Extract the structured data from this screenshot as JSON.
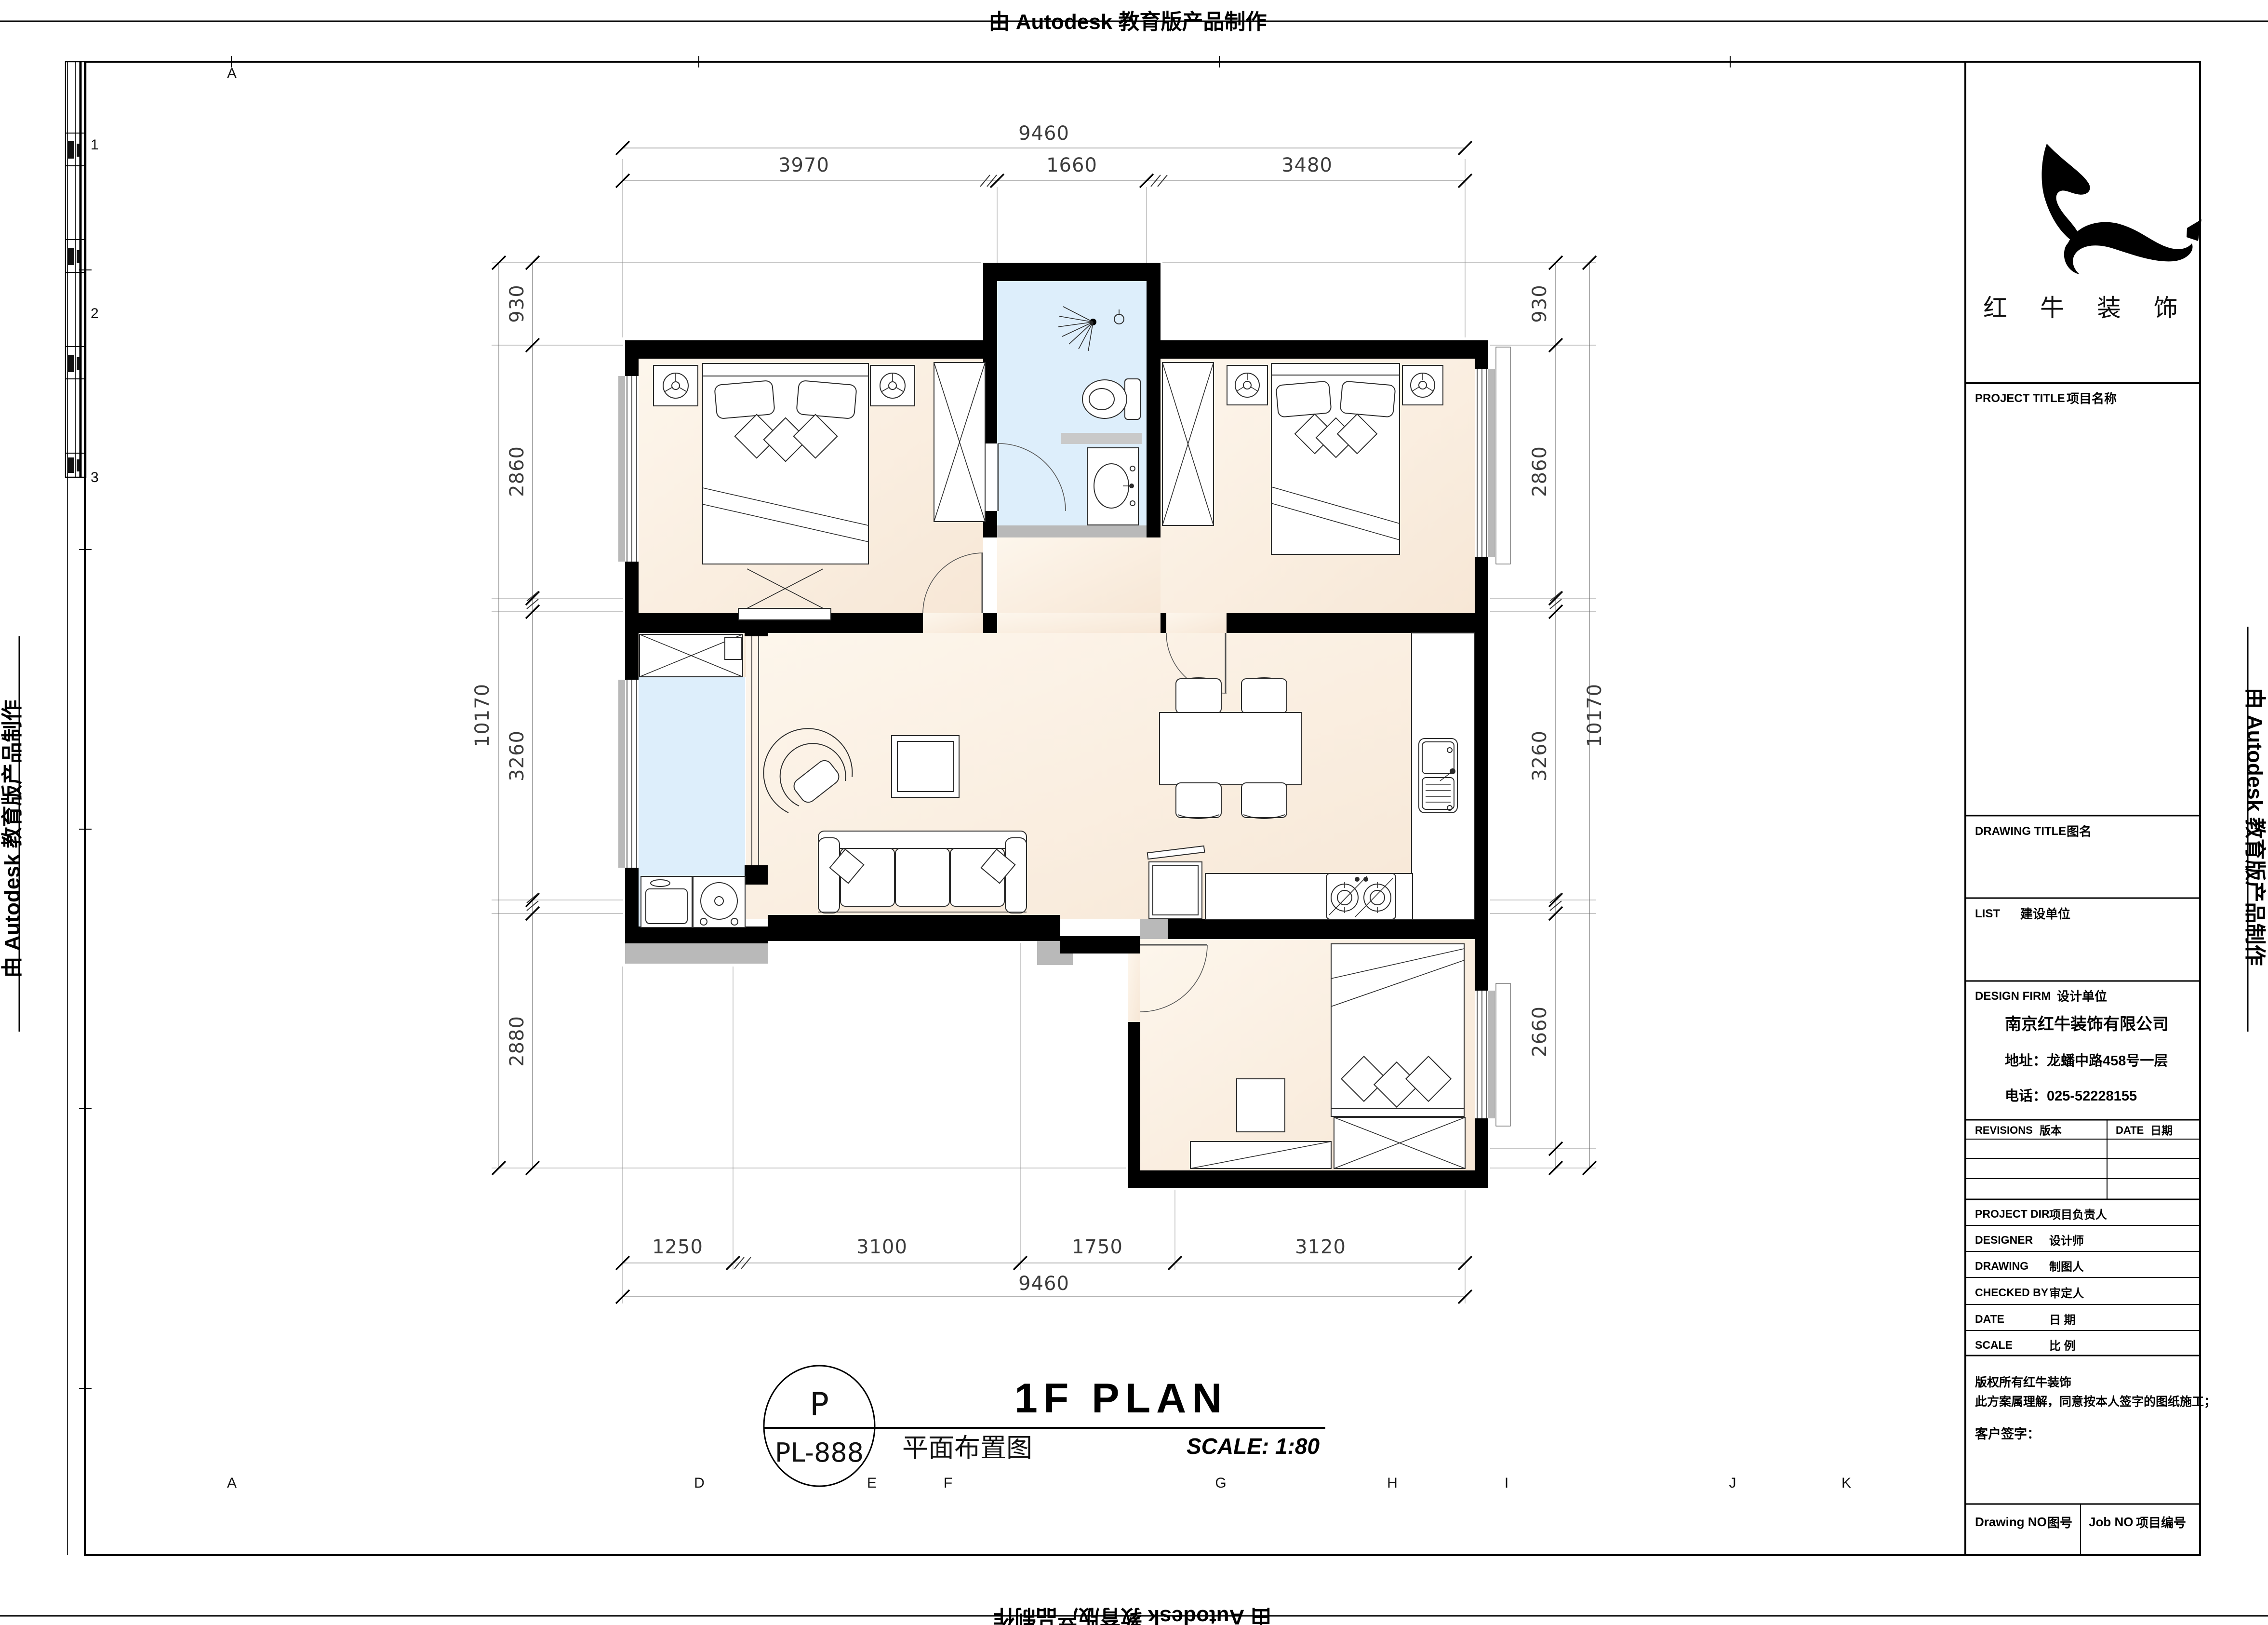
{
  "watermarks": {
    "top": "由 Autodesk 教育版产品制作",
    "bottom": "由 Autodesk 教育版产品制作",
    "left": "由 Autodesk 教育版产品制作",
    "right": "由 Autodesk 教育版产品制作"
  },
  "sheet": {
    "grid_top_letter": "A",
    "grid_bottom_letters": [
      "A",
      "D",
      "E",
      "F",
      "G",
      "H",
      "I",
      "J",
      "K"
    ],
    "grid_left_numbers": [
      "1",
      "2",
      "3"
    ]
  },
  "title_block": {
    "brand_name": "红 牛 装 饰",
    "sections": {
      "project_title_en": "PROJECT TITLE",
      "project_title_zh": "项目名称",
      "drawing_title_en": "DRAWING TITLE",
      "drawing_title_zh": "图名",
      "list_en": "LIST",
      "list_zh": "建设单位",
      "design_firm_en": "DESIGN FIRM",
      "design_firm_zh": "设计单位"
    },
    "company": {
      "name": "南京红牛装饰有限公司",
      "address": "地址：龙蟠中路458号一层",
      "phone": "电话：025-52228155"
    },
    "revisions_en": "REVISIONS",
    "revisions_zh": "版本",
    "date_col_en": "DATE",
    "date_col_zh": "日期",
    "rows": [
      {
        "en": "PROJECT DIR",
        "zh": "项目负责人"
      },
      {
        "en": "DESIGNER",
        "zh": "设计师"
      },
      {
        "en": "DRAWING",
        "zh": "制图人"
      },
      {
        "en": "CHECKED BY",
        "zh": "审定人"
      },
      {
        "en": "DATE",
        "zh": "日  期"
      },
      {
        "en": "SCALE",
        "zh": "比  例"
      }
    ],
    "note_line1": "版权所有红牛装饰",
    "note_line2": "此方案属理解，同意按本人签字的图纸施工；",
    "note_line3": "客户签字：",
    "footer_left_en": "Drawing NO",
    "footer_left_zh": "图号",
    "footer_right_en": "Job NO",
    "footer_right_zh": "项目编号"
  },
  "caption": {
    "bubble_top": "P",
    "bubble_bottom": "PL-888",
    "title": "1F PLAN",
    "subtitle": "平面布置图",
    "scale_label": "SCALE:  1:80"
  },
  "dimensions": {
    "top": {
      "overall": "9460",
      "seg1": "3970",
      "seg2": "1660",
      "seg3": "3480"
    },
    "bottom": {
      "overall": "9460",
      "seg1": "1250",
      "seg2": "3100",
      "seg3": "1750",
      "seg4": "3120"
    },
    "left": {
      "overall": "10170",
      "seg1": "930",
      "seg2": "2860",
      "seg3": "3260",
      "seg4": "2880"
    },
    "right": {
      "overall": "10170",
      "seg1": "930",
      "seg2": "2860",
      "seg3": "3260",
      "seg4": "2660"
    }
  }
}
